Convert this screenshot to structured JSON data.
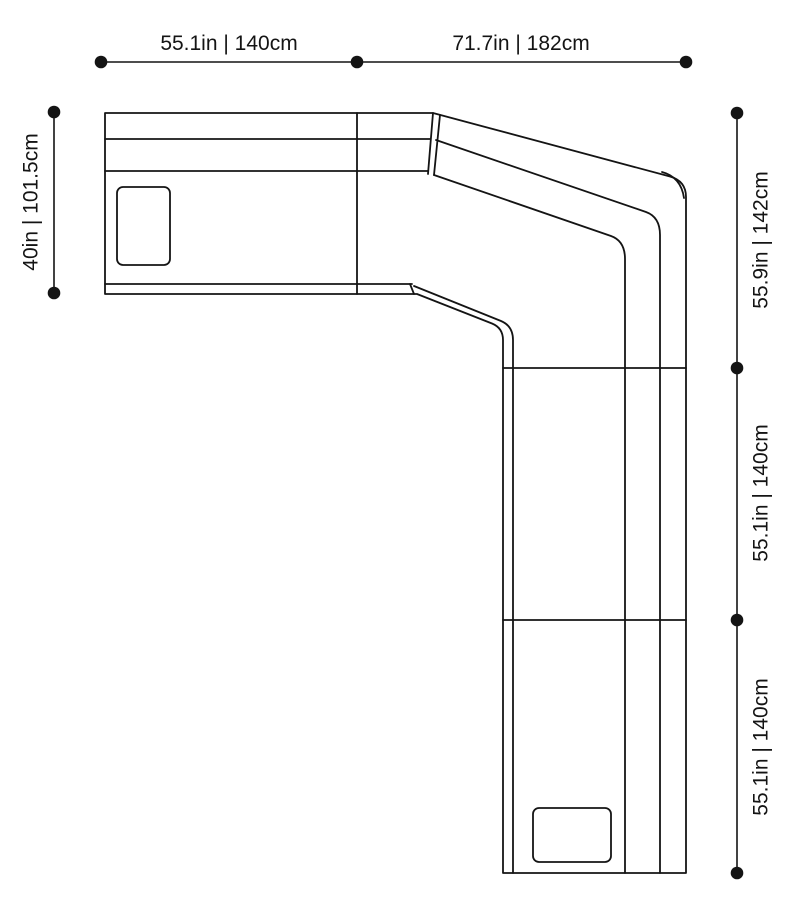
{
  "diagram": {
    "type": "sofa-plan-dimension-diagram",
    "colors": {
      "line": "#141414",
      "background": "#ffffff"
    },
    "dimensions": {
      "top": [
        {
          "label": "55.1in | 140cm"
        },
        {
          "label": "71.7in | 182cm"
        }
      ],
      "left": [
        {
          "label": "40in | 101.5cm"
        }
      ],
      "right": [
        {
          "label": "55.9in | 142cm"
        },
        {
          "label": "55.1in | 140cm"
        },
        {
          "label": "55.1in | 140cm"
        }
      ]
    }
  }
}
